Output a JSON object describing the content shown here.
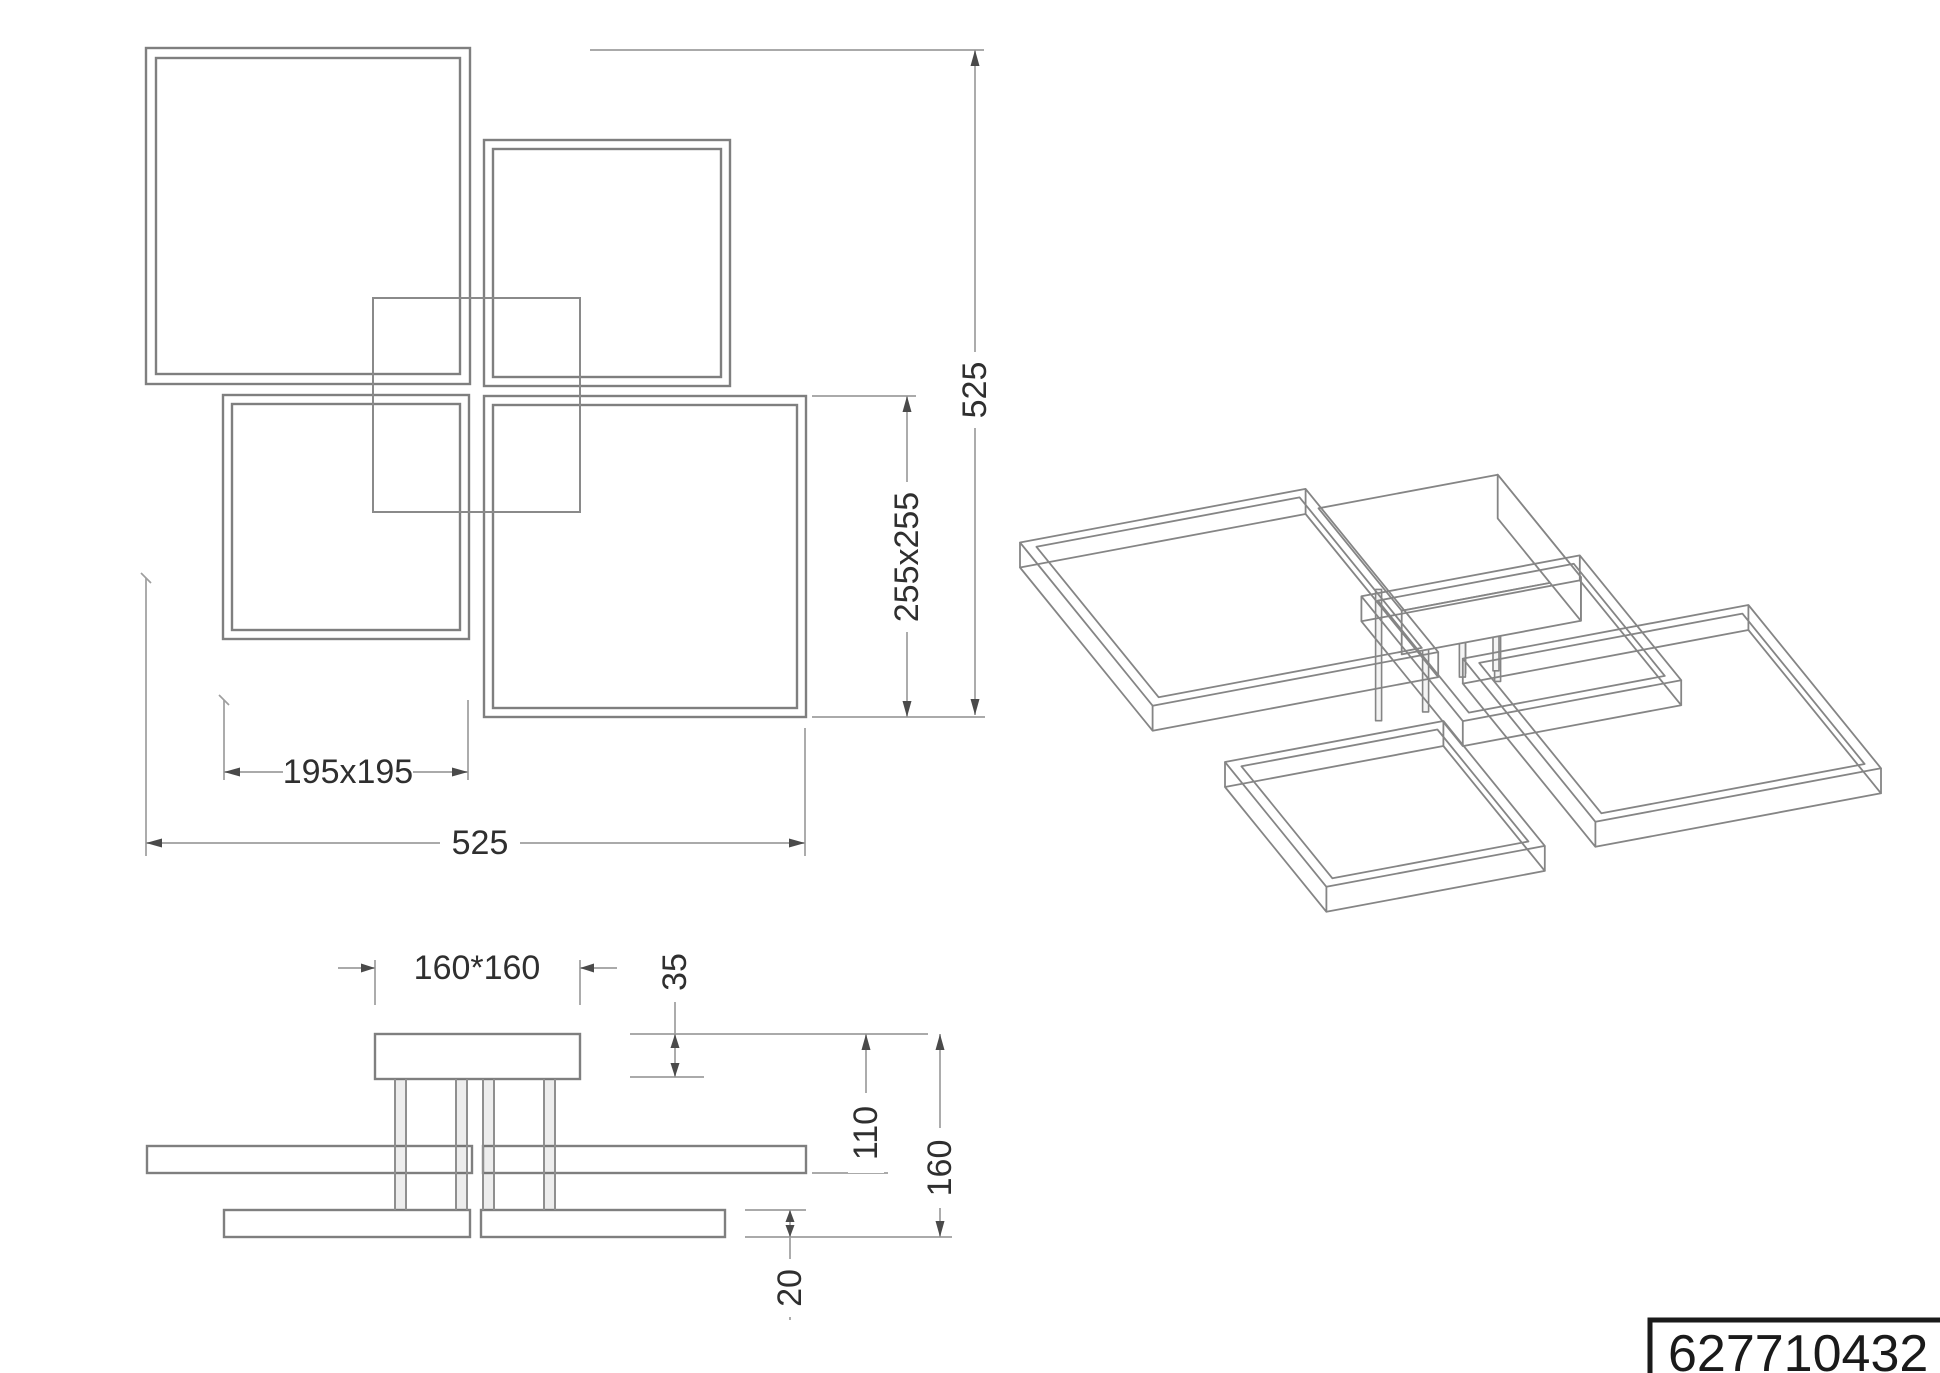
{
  "part_number": {
    "value": "627710432"
  },
  "plan_view": {
    "small_frames_label": "195x195",
    "total_width_label": "525",
    "large_frames_label": "255x255",
    "total_height_label": "525"
  },
  "side_view": {
    "canopy_label": "160*160",
    "canopy_height_label": "35",
    "upper_drop_label": "110",
    "total_drop_label": "160",
    "profile_height_label": "20"
  },
  "fixture_model": {
    "units": "mm",
    "canopy": {
      "x1": 182,
      "y1": 182,
      "x2": 342,
      "y2": 342,
      "height": 35
    },
    "frame_thickness": 20,
    "frame_profile_width": 10,
    "frames": [
      {
        "id": "frame-a",
        "size": "255x255",
        "x1": 0,
        "y1": 0,
        "x2": 255,
        "y2": 255,
        "z_top": 90
      },
      {
        "id": "frame-d",
        "size": "255x255",
        "x1": 270,
        "y1": 270,
        "x2": 525,
        "y2": 525,
        "z_top": 90
      },
      {
        "id": "frame-b",
        "size": "195x195",
        "x1": 270,
        "y1": 75,
        "x2": 465,
        "y2": 270,
        "z_top": 140
      },
      {
        "id": "frame-c",
        "size": "195x195",
        "x1": 60,
        "y1": 265,
        "x2": 255,
        "y2": 460,
        "z_top": 140
      }
    ],
    "rods": [
      {
        "x": 205,
        "y": 248,
        "z_end": 140
      },
      {
        "x": 247,
        "y": 248,
        "z_end": 140
      },
      {
        "x": 300,
        "y": 205,
        "z_end": 140
      },
      {
        "x": 322,
        "y": 225,
        "z_end": 140
      },
      {
        "x": 258,
        "y": 295,
        "z_end": 90
      },
      {
        "x": 288,
        "y": 295,
        "z_end": 90
      }
    ]
  },
  "colors": {
    "drawing_line": "#7f7f7f",
    "dimension_line": "#9e9e9e",
    "text": "#2f2f2f",
    "background": "#ffffff",
    "part_box_border": "#1a1a1a"
  }
}
